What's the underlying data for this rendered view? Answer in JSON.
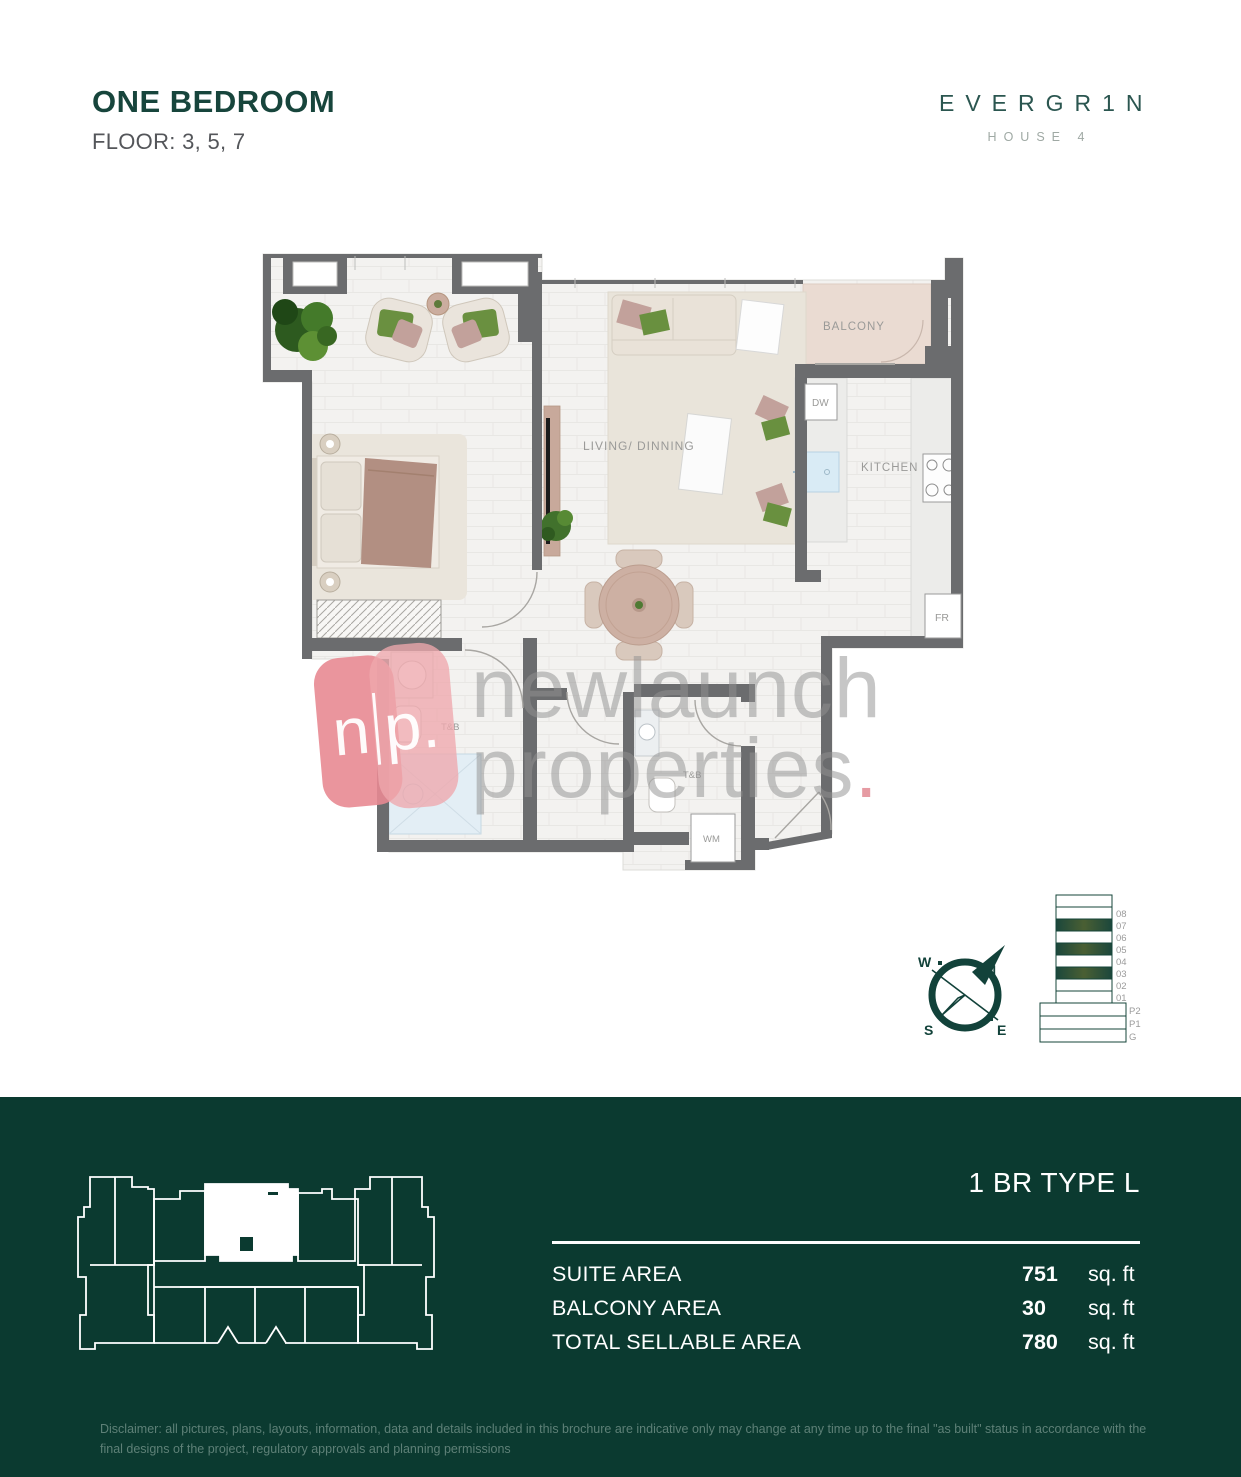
{
  "header": {
    "title": "ONE BEDROOM",
    "floors": "FLOOR: 3, 5, 7"
  },
  "brand": {
    "name": "EVERGR1N",
    "subtitle": "HOUSE 4"
  },
  "floor_plan": {
    "rooms": {
      "balcony": "BALCONY",
      "living": "LIVING/ DINNING",
      "kitchen": "KITCHEN",
      "dw": "DW",
      "fr": "FR",
      "tb1": "T&B",
      "tb2": "T&B",
      "wm": "WM"
    }
  },
  "compass": {
    "n": "N",
    "s": "S",
    "e": "E",
    "w": "W"
  },
  "stack": {
    "floors": [
      "08",
      "07",
      "06",
      "05",
      "04",
      "03",
      "02",
      "01"
    ],
    "base": [
      "P2",
      "P1",
      "G"
    ],
    "highlighted_floors": [
      "07",
      "05",
      "03"
    ]
  },
  "watermark": {
    "logo_n": "n",
    "logo_p": "p.",
    "line1": "newlaunch",
    "line2": "properties",
    "period": "."
  },
  "footer": {
    "type_title": "1 BR TYPE L",
    "rows": [
      {
        "label": "SUITE AREA",
        "value": "751",
        "unit": "sq. ft"
      },
      {
        "label": "BALCONY AREA",
        "value": "30",
        "unit": "sq. ft"
      },
      {
        "label": "TOTAL SELLABLE AREA",
        "value": "780",
        "unit": "sq. ft"
      }
    ],
    "disclaimer": "Disclaimer: all pictures, plans, layouts, information, data and details included in this brochure are indicative only may change at any time up to the final \"as built\" status in accordance with the final designs of the project, regulatory approvals and planning permissions"
  },
  "colors": {
    "brand_green": "#17453c",
    "footer_green": "#0b3a30",
    "watermark_pink": "#e88a92",
    "wall_gray": "#6b6c6e",
    "balcony_beige": "#eadbd2"
  }
}
